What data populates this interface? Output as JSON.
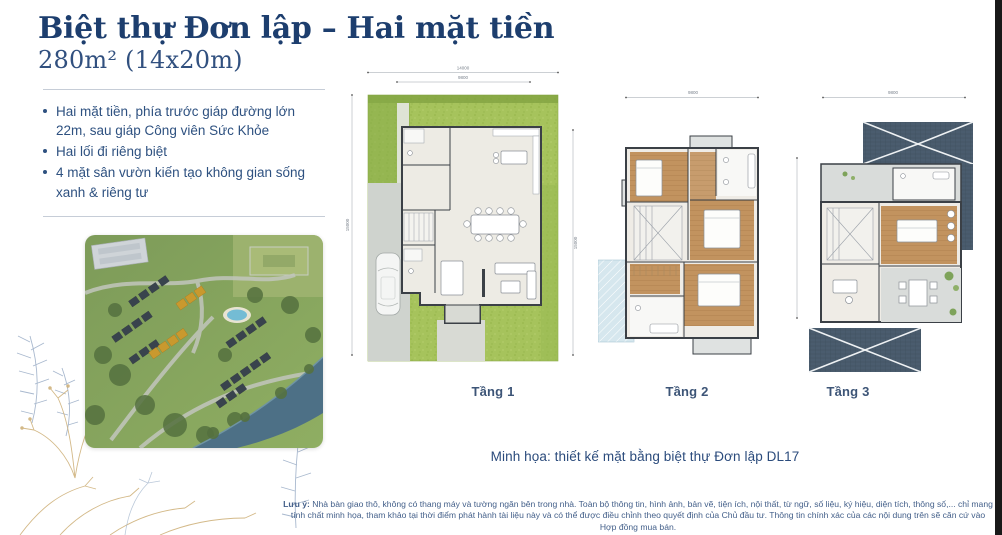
{
  "page": {
    "title": "Biệt thự Đơn lập – Hai mặt tiền",
    "subtitle": "280m² (14x20m)"
  },
  "highlights": {
    "items": [
      "Hai mặt tiền, phía trước giáp đường lớn 22m, sau giáp Công viên Sức Khỏe",
      "Hai lối đi riêng biệt",
      "4 mặt sân vườn kiến tạo không gian sống xanh & riêng tư"
    ]
  },
  "plans": {
    "caption": "Minh họa: thiết kế mặt bằng biệt thự Đơn lập DL17",
    "floors": [
      {
        "label": "Tầng 1",
        "dims": {
          "top": "14000",
          "top_inner": "9800",
          "left": "15000",
          "right": "15000"
        }
      },
      {
        "label": "Tầng 2",
        "dims": {
          "top": "9800"
        }
      },
      {
        "label": "Tầng 3",
        "dims": {
          "top": "9800"
        }
      }
    ]
  },
  "disclaimer": {
    "label": "Lưu ý:",
    "text": " Nhà bàn giao thô, không có thang máy và tường ngăn bên trong nhà. Toàn bộ thông tin, hình ảnh, bản vẽ, tiện ích, nội thất, từ ngữ, số liệu, ký hiệu, diện tích, thông số,... chỉ mang tính chất minh họa, tham khảo tại thời điểm phát hành tài liệu này và có thể được điều chỉnh theo quyết định của Chủ đầu tư. Thông tin chính xác của các nội dung trên sẽ căn cứ vào Hợp đồng mua bán."
  },
  "colors": {
    "accent_navy": "#1d3e6e",
    "body_blue": "#2e5180",
    "lawn_green": "#a6c35c",
    "roof_slate": "#4a5c6e",
    "wood_floor": "#c2935f",
    "highlight_gold": "#c9992e",
    "river_blue": "#4d7086",
    "edge_bar": "#191919"
  }
}
